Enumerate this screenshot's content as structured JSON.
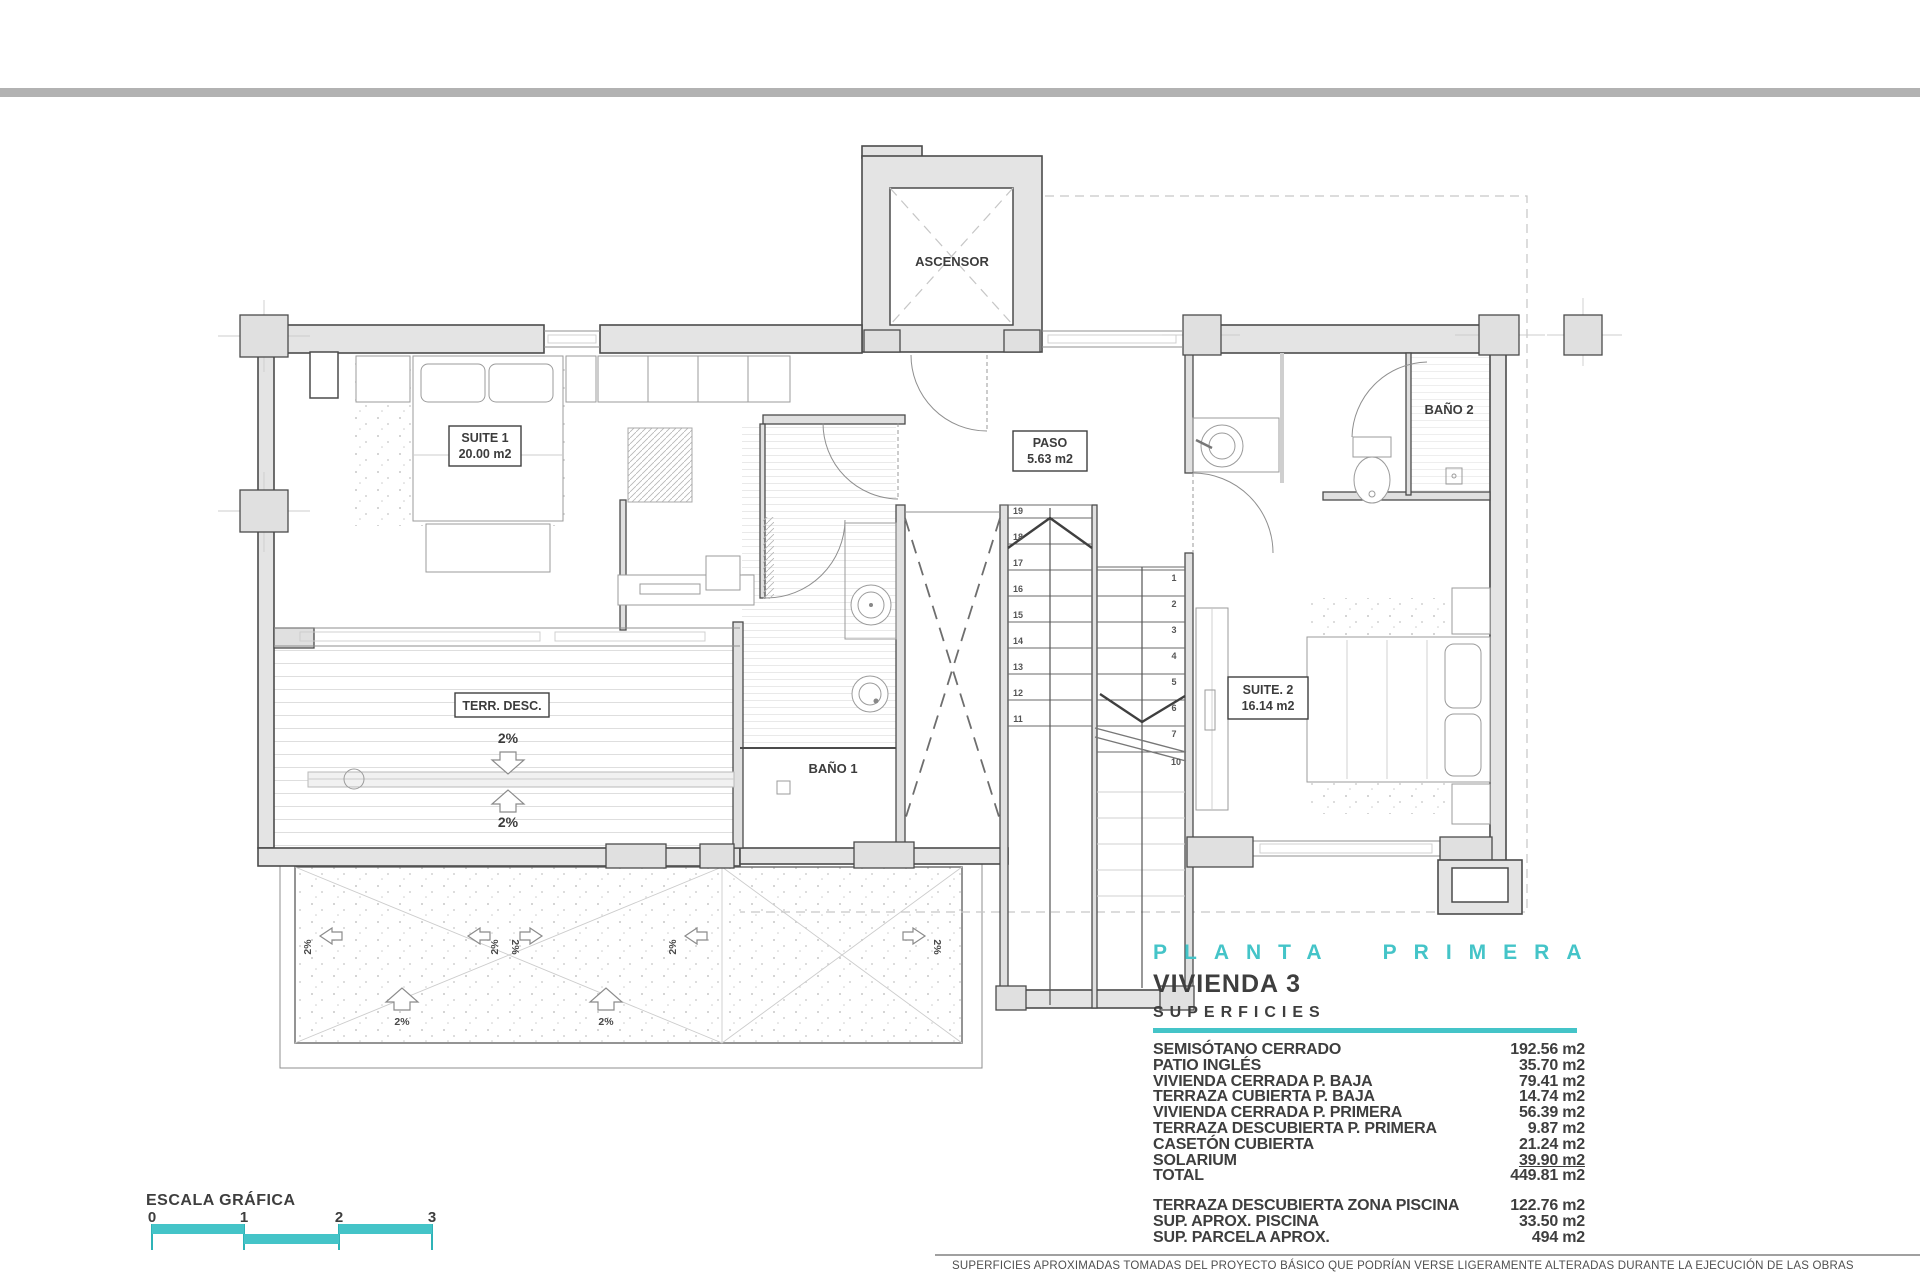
{
  "colors": {
    "teal": "#44c4c8",
    "top_bar": "#b2b2b2"
  },
  "plan": {
    "elevator": {
      "label": "ASCENSOR"
    },
    "suite1": {
      "name": "SUITE 1",
      "area": "20.00 m2"
    },
    "paso": {
      "name": "PASO",
      "area": "5.63 m2"
    },
    "bano1": {
      "name": "BAÑO 1"
    },
    "bano2": {
      "name": "BAÑO 2"
    },
    "suite2": {
      "name": "SUITE. 2",
      "area": "16.14 m2"
    },
    "terrace": {
      "name": "TERR. DESC."
    },
    "slope": "2%",
    "stairs": {
      "up": [
        "19",
        "18",
        "17",
        "16",
        "15",
        "14",
        "13",
        "12",
        "11"
      ],
      "down": [
        "1",
        "2",
        "3",
        "4",
        "5",
        "6",
        "7"
      ],
      "landing": "10"
    }
  },
  "title_block": {
    "floor": "PLANTA PRIMERA",
    "unit": "VIVIENDA 3",
    "section": "SUPERFICIES",
    "rows": [
      {
        "label": "SEMISÓTANO CERRADO",
        "value": "192.56 m2"
      },
      {
        "label": "PATIO INGLÉS",
        "value": "35.70 m2"
      },
      {
        "label": "VIVIENDA CERRADA P. BAJA",
        "value": "79.41 m2"
      },
      {
        "label": "TERRAZA CUBIERTA P. BAJA",
        "value": "14.74 m2"
      },
      {
        "label": "VIVIENDA CERRADA P. PRIMERA",
        "value": "56.39 m2"
      },
      {
        "label": "TERRAZA DESCUBIERTA P. PRIMERA",
        "value": "9.87 m2"
      },
      {
        "label": "CASETÓN CUBIERTA",
        "value": "21.24 m2"
      },
      {
        "label": "SOLARIUM",
        "value": "39.90 m2"
      },
      {
        "label": "TOTAL",
        "value": "449.81 m2"
      }
    ],
    "extra_rows": [
      {
        "label": "TERRAZA DESCUBIERTA  ZONA PISCINA",
        "value": "122.76 m2"
      },
      {
        "label": "SUP.  APROX.  PISCINA",
        "value": "33.50 m2"
      },
      {
        "label": "SUP. PARCELA APROX.",
        "value": "494 m2"
      }
    ]
  },
  "scale_bar": {
    "label": "ESCALA GRÁFICA",
    "ticks": [
      "0",
      "1",
      "2",
      "3"
    ]
  },
  "disclaimer": "SUPERFICIES APROXIMADAS TOMADAS DEL PROYECTO BÁSICO QUE PODRÍAN VERSE LIGERAMENTE ALTERADAS DURANTE LA EJECUCIÓN DE LAS OBRAS"
}
